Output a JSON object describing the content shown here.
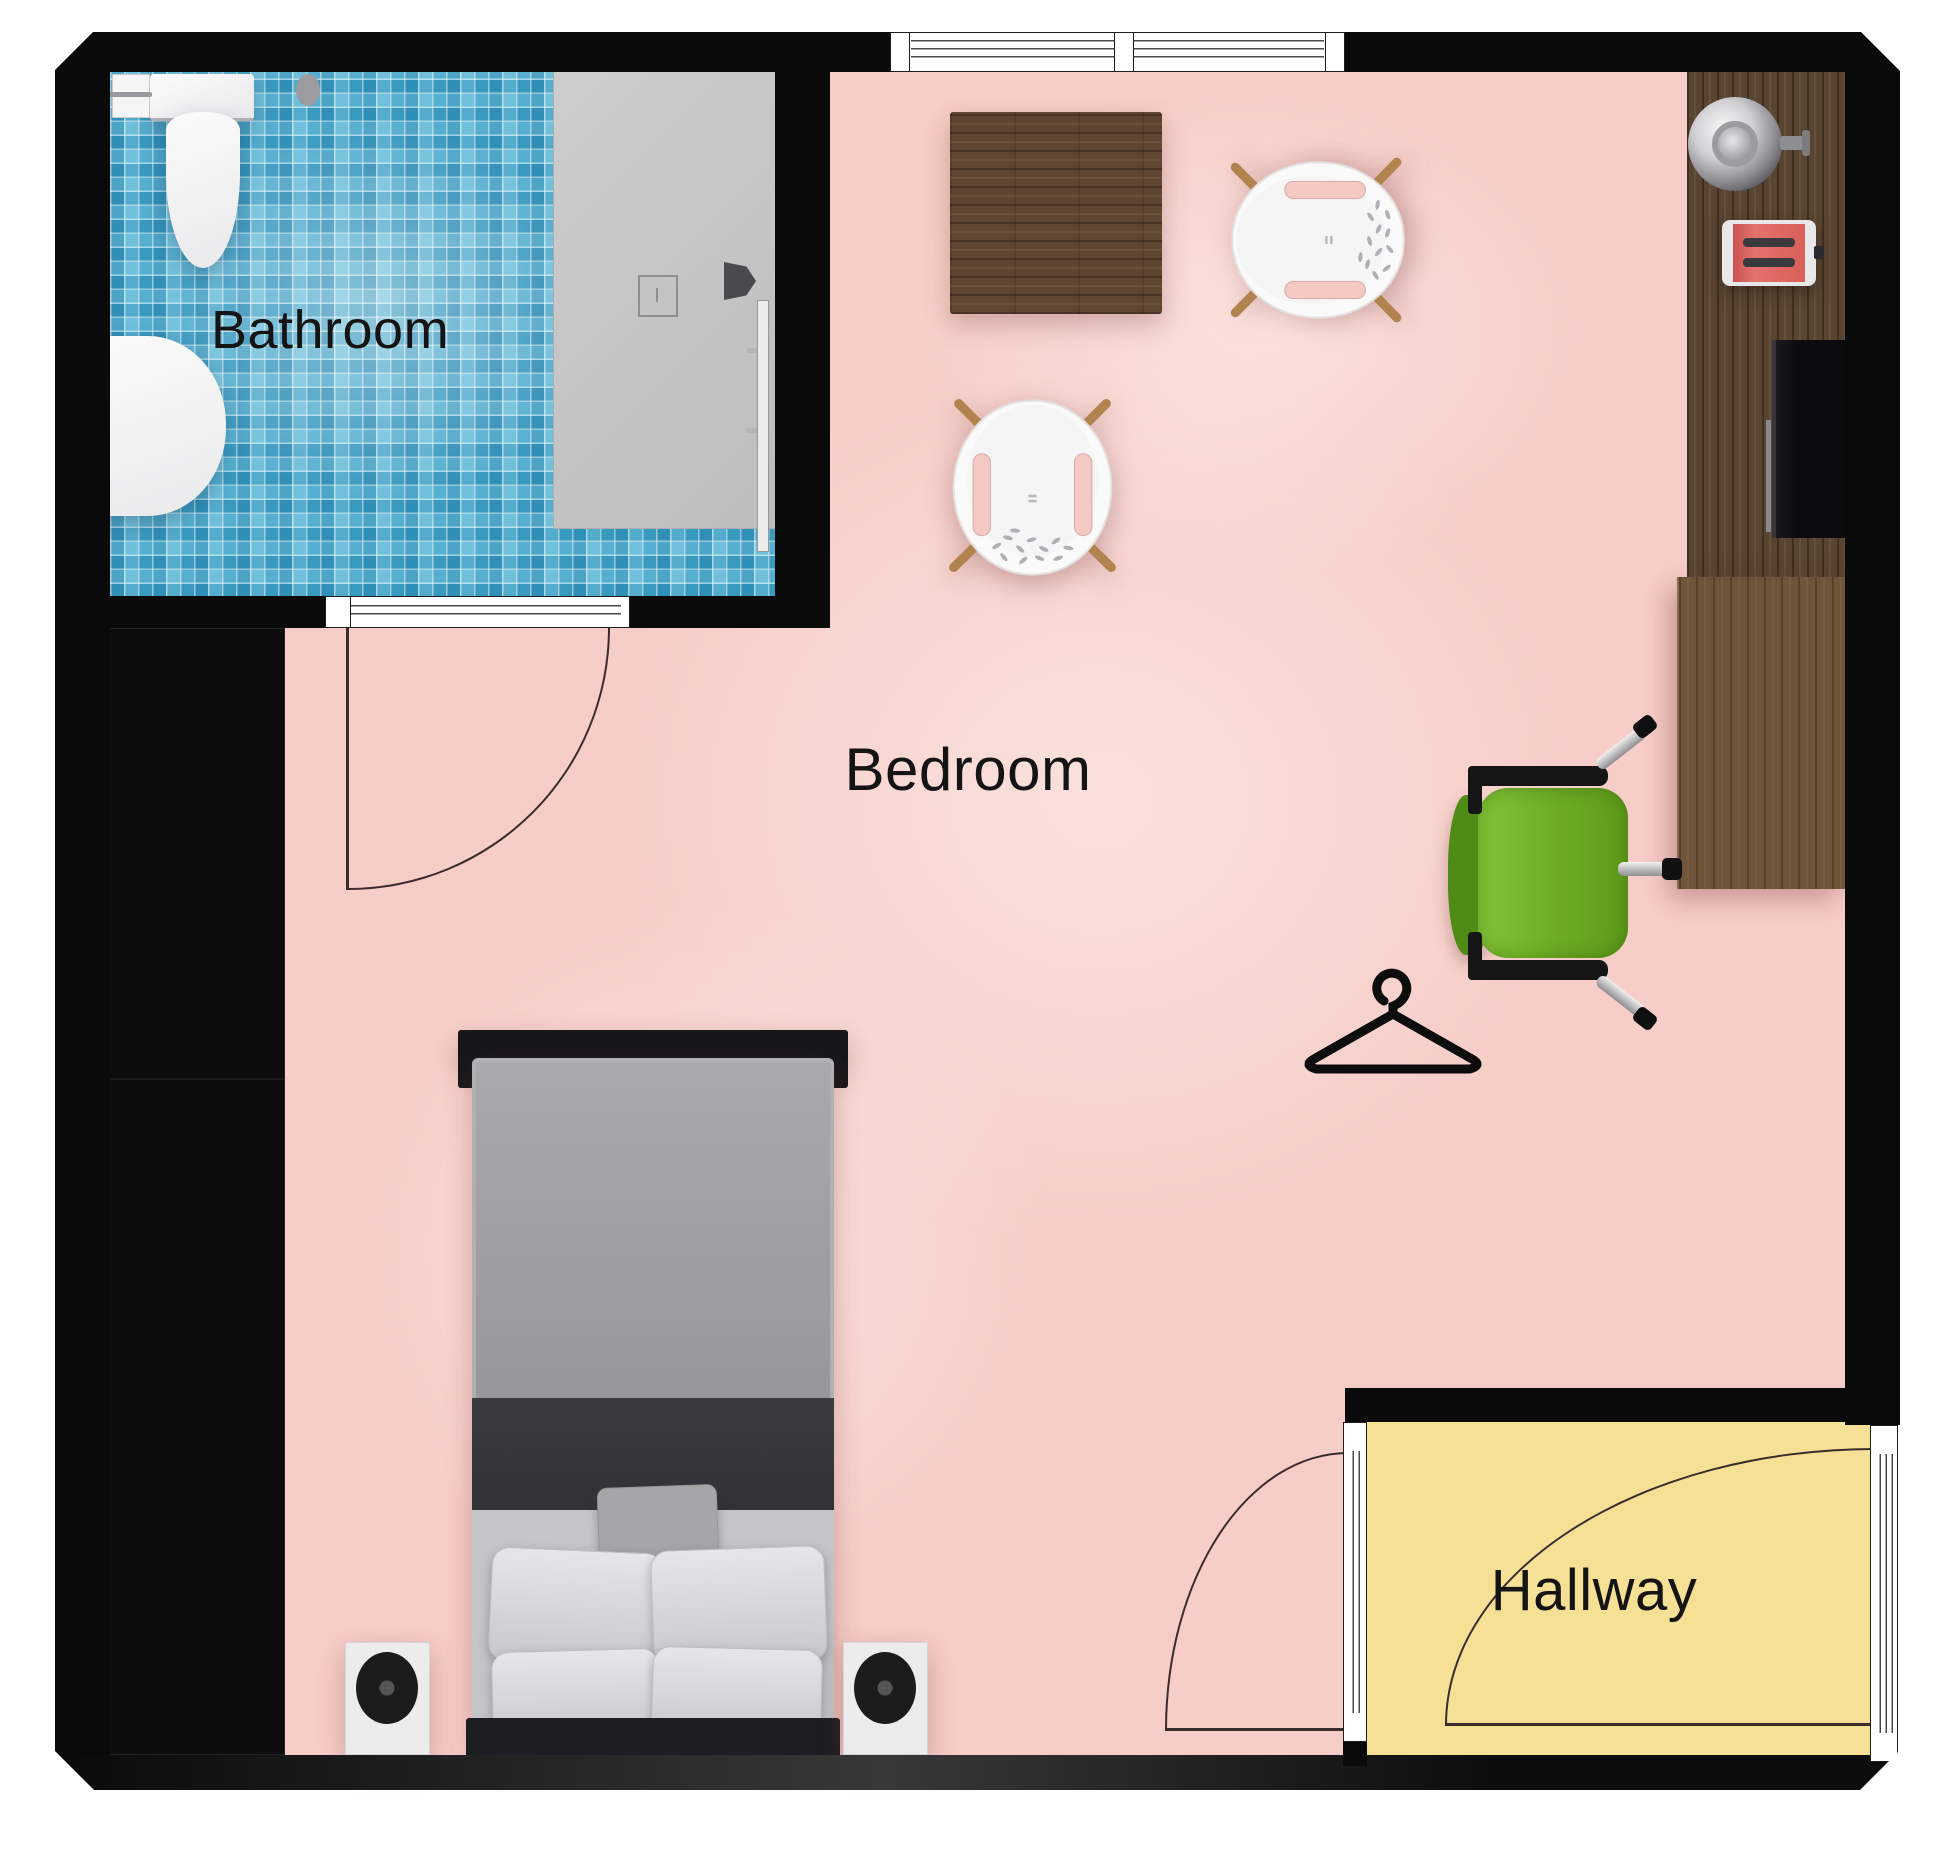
{
  "plan": {
    "type": "apartment-floor-plan",
    "rooms": [
      {
        "id": "bathroom",
        "label": "Bathroom"
      },
      {
        "id": "bedroom",
        "label": "Bedroom"
      },
      {
        "id": "hallway",
        "label": "Hallway"
      }
    ],
    "colors": {
      "bedroom_floor": "#f7cdc7",
      "hallway_floor": "#f5e096",
      "bathroom_tile": "#46a9cd",
      "shower_pan": "#c8c8c8",
      "wall": "#0a0a0a",
      "counter_wood": "#584430",
      "desk_wood": "#70543a",
      "table_wood": "#5f4630",
      "office_chair_green": "#6fae2a",
      "toaster_red": "#d95f58",
      "chair_leg_wood": "#b1834e"
    },
    "furniture": [
      "toilet",
      "toilet-paper-holder",
      "sink-vanity",
      "shower",
      "shower-head",
      "floor-drain",
      "dining-table",
      "armchair-right",
      "armchair-bottom",
      "kitchen-counter",
      "kettle",
      "toaster",
      "tv",
      "desk",
      "office-chair",
      "clothes-hanger",
      "double-bed",
      "pillows",
      "nightstand-left",
      "nightstand-right",
      "lamp-left",
      "lamp-right"
    ]
  }
}
